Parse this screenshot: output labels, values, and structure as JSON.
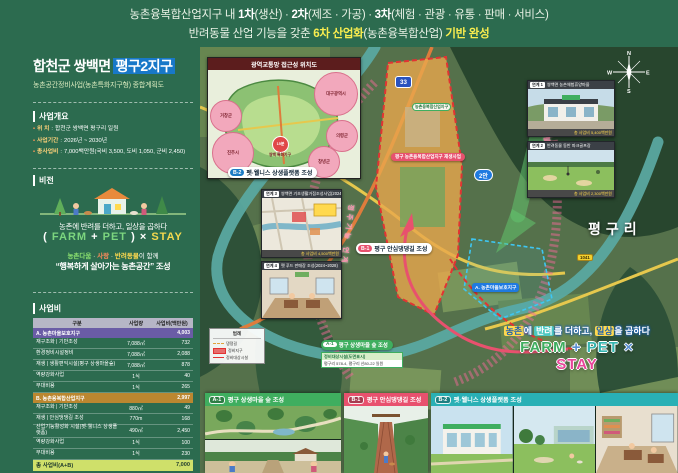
{
  "banner": {
    "l1a": "농촌융복합산업지구 내 ",
    "l1b": "1차",
    "l1c": "(생산) · ",
    "l1d": "2차",
    "l1e": "(제조 · 가공) · ",
    "l1f": "3차",
    "l1g": "(체험 · 관광 · 유통 · 판매 · 서비스)",
    "l2a": "반려동물 산업 기능을 갖춘 ",
    "l2b": "6차 산업화",
    "l2c": "(농촌융복합산업) ",
    "l2d": "기반 완성"
  },
  "sidebar": {
    "title": {
      "region": "합천군 쌍백면",
      "zone": "평구2지구",
      "subtitle": "농촌공간정비사업(농촌특화지구형) 종합계획도"
    },
    "overview": {
      "heading": "사업개요",
      "items": [
        {
          "label": "위 치",
          "value": "합천군 쌍백면 평구리 일원"
        },
        {
          "label": "사업기간",
          "value": "2026년 ~ 2030년"
        },
        {
          "label": "총사업비",
          "value": "7,000백만원(국비 3,500, 도비 1,050, 군비 2,450)"
        }
      ]
    },
    "vision": {
      "heading": "비전",
      "tagline": "농촌에 반려를 더하고, 일상을 곱하다",
      "formula": {
        "open": "(",
        "farm": "FARM",
        "plus": "+",
        "pet": "PET",
        "close": ")",
        "times": "×",
        "stay": "STAY"
      },
      "together": {
        "a": "농촌다움",
        "dot1": " · ",
        "b": "사랑",
        "dot2": " · ",
        "c": "반려동물",
        "rest": "이 함께"
      },
      "slogan": "“행복하게 살아가는 농촌공간” 조성"
    },
    "budget": {
      "heading": "사업비",
      "headers": {
        "col1": "구분",
        "col2": "사업량",
        "col3": "사업비(백만원)"
      },
      "sectionA": {
        "label": "A. 농촌마을보호지구",
        "total": "4,003"
      },
      "rowsA": [
        {
          "name": "재구조화 | 기반조성",
          "qty": "7,088㎡",
          "cost": "732"
        },
        {
          "name": "환경정비시설정비",
          "qty": "7,088㎡",
          "cost": "2,088"
        },
        {
          "name": "재생 | 생활편익시설(평구 상생마을숲)",
          "qty": "7,088㎡",
          "cost": "878"
        },
        {
          "name": "역량강화사업",
          "qty": "1식",
          "cost": "40"
        },
        {
          "name": "부대비용",
          "qty": "1식",
          "cost": "265"
        }
      ],
      "sectionB": {
        "label": "B. 농촌융복합산업지구",
        "total": "2,997"
      },
      "rowsB": [
        {
          "name": "재구조화 | 기반조성",
          "qty": "880㎡",
          "cost": "49"
        },
        {
          "name": "재생 | 안심댕댕길 조성",
          "qty": "770m",
          "cost": "168"
        },
        {
          "name": "산업기능활성화 시설(펫·웰니스 상생플랫폼)",
          "qty": "490㎡",
          "cost": "2,450"
        },
        {
          "name": "역량강화사업",
          "qty": "1식",
          "cost": "100"
        },
        {
          "name": "부대비용",
          "qty": "1식",
          "cost": "230"
        }
      ],
      "totalRow": {
        "label": "총 사업비(A+B)",
        "value": "7,000"
      }
    }
  },
  "map": {
    "traffic": {
      "title": "광역교통망 접근성 위치도",
      "circles": [
        "거창군",
        "대구광역시",
        "진주시",
        "의령군",
        "창녕군"
      ],
      "center": {
        "name": "쌍백 특화지구",
        "time": "15분"
      }
    },
    "pills": {
      "b2_id": "B-2",
      "b2": "펫·웰니스 상생플랫폼 조성",
      "b1_id": "B-1",
      "b1": "평구 안심댕댕길 조성",
      "a1_id": "A-1",
      "a1": "평구 상생마을 숲 조성",
      "azone": "A. 농촌마을보호지구",
      "project": "평구 농촌융복합산업지구 재생사업",
      "alt": "2안",
      "zone": "농촌융복합산업지구"
    },
    "roads": {
      "r33": "33",
      "r1041": "1041"
    },
    "village": "평구리",
    "arcs": {
      "right": "생활서비스 연계",
      "left": "정주기능 연계"
    },
    "callout": {
      "title": "정비대상시설(도면표시)",
      "text": "평구리 578-4, 평구리 산80-22 일원"
    },
    "legend": {
      "title": "범례",
      "i1": "댕댕길",
      "i2": "정비지구",
      "i3": "정비대상시설"
    },
    "compass": {
      "n": "N",
      "w": "W",
      "e": "E",
      "s": "S"
    },
    "links": [
      {
        "tag": "연계 1",
        "title": "쌍백면 농촌체험휴양마을",
        "caption": "총 사업비 5,400백만원"
      },
      {
        "tag": "연계 2",
        "title": "반려동물 동반 파크골프장",
        "caption": "총 사업비 2,300백만원"
      },
      {
        "tag": "연계 3",
        "title": "쌍백면 기초생활거점조성사업(2024~2030)",
        "caption": "총 사업비 4,500백만원"
      },
      {
        "tag": "연계 4",
        "title": "펫 푸드 판매장 조성(2024~2028)"
      }
    ],
    "tagline": {
      "a": "농촌",
      "b": "에 ",
      "c": "반려",
      "d": "를 더하고, ",
      "e": "일상",
      "f": "을 곱하다"
    },
    "logo": {
      "farm": "FARM",
      "plus": "+",
      "pet": "PET",
      "times": "×",
      "stay": "STAY"
    }
  },
  "bottom": {
    "panels": [
      {
        "id": "A-1",
        "title": "평구 상생마을 숲 조성"
      },
      {
        "id": "B-1",
        "title": "평구 안심댕댕길 조성"
      },
      {
        "id": "B-2",
        "title": "펫·웰니스 상생플랫폼 조성"
      }
    ]
  },
  "colors": {
    "background_green": "#2c6b4f",
    "accent_yellow": "#f9ed4f",
    "accent_blue": "#1d7cc5",
    "accent_pink": "#e8516e",
    "accent_teal": "#29b0b5",
    "accent_green": "#3fae5f",
    "table_section_a": "#6a5ca6",
    "table_section_b": "#bb8730",
    "table_total": "#cfe06a"
  }
}
